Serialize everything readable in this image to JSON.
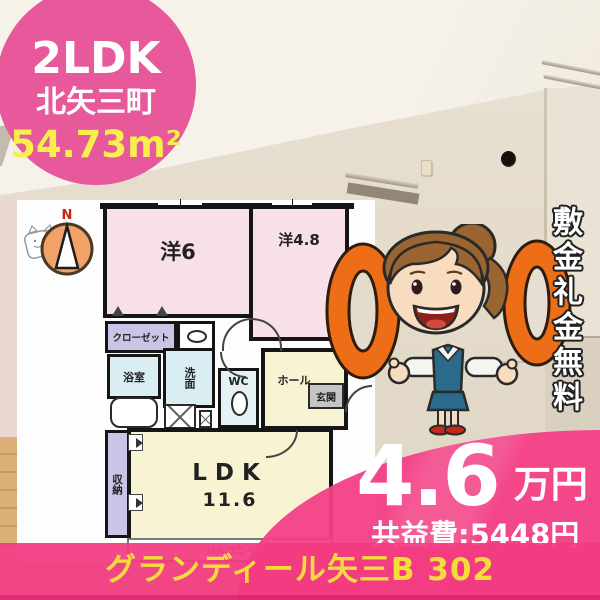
{
  "badge": {
    "layout_type": "2LDK",
    "location": "北矢三町",
    "area": "54.73m²"
  },
  "floorplan": {
    "compass": "N",
    "rooms": {
      "western6": "洋6",
      "western48": "洋4.8",
      "closet": "クローゼット",
      "bath": "浴室",
      "washroom": "洗面",
      "wc": "WC",
      "hall": "ホール",
      "entrance": "玄関",
      "ldk": "LDK",
      "ldk_size": "11.6",
      "storage": "収納",
      "balcony": "バルコニー"
    }
  },
  "promo": {
    "vertical_text": "敷金礼金無料",
    "zeros": "00"
  },
  "price": {
    "amount": "4.6",
    "unit": "万円",
    "common_fee": "共益費:5448円"
  },
  "footer": {
    "building_name": "グランディール矢三B 302"
  },
  "colors": {
    "accent_pink": "#e7599b",
    "deep_pink": "#f23e86",
    "accent_yellow": "#f8ef4e",
    "zero_orange": "#ee6d17"
  }
}
